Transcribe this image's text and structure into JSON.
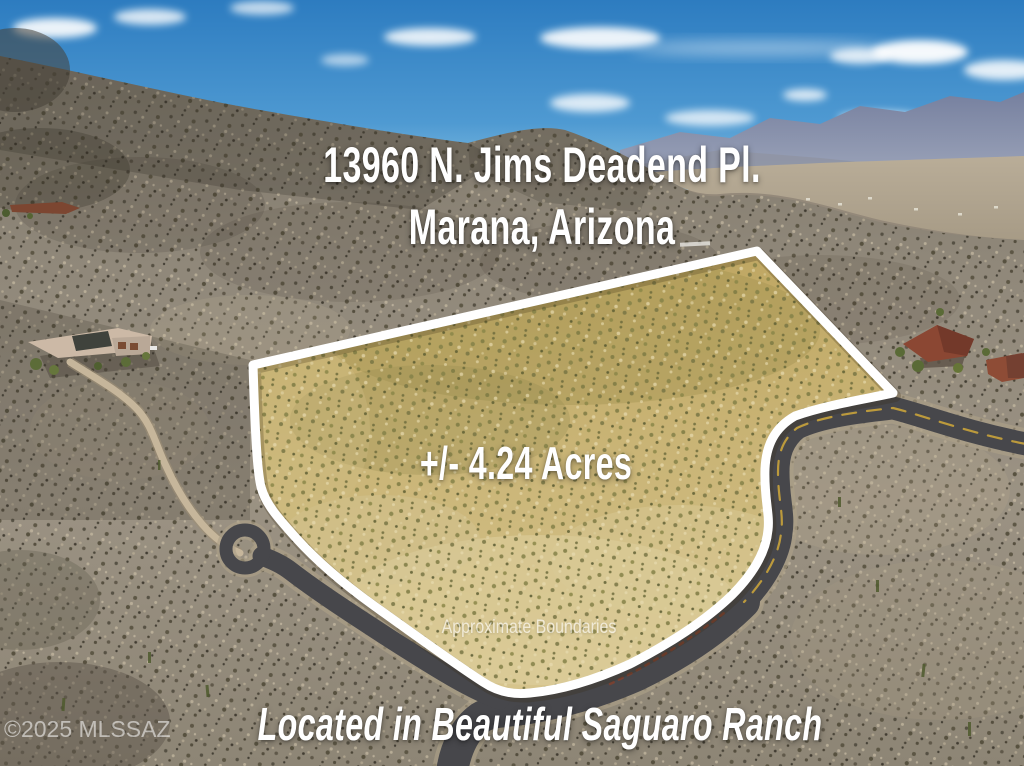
{
  "overlay": {
    "title_line1": "13960 N. Jims Deadend Pl.",
    "title_line2": "Marana, Arizona",
    "acreage": "+/- 4.24 Acres",
    "boundaries_note": "Approximate Boundaries",
    "tagline": "Located in Beautiful Saguaro Ranch",
    "watermark": "©2025 MLSSAZ"
  },
  "scene": {
    "description": "aerial-photo-of-desert-land-parcel",
    "parcel": {
      "label": "+/- 4.24 Acres",
      "boundary_style": "white-outline"
    }
  },
  "colors": {
    "sky_top": "#2d7cc0",
    "sky_mid": "#4f9ad2",
    "sky_horizon": "#8ec6e4",
    "cloud": "#ffffff",
    "mountain_top": "#76809f",
    "mountain_bottom": "#9aa2b8",
    "foothill": "#8f94a3",
    "valley_top": "#b9ad98",
    "valley_bottom": "#a79b86",
    "desert_hill": "#7e776a",
    "desert_mid": "#9b9283",
    "desert_low": "#8d8575",
    "parcel_top": "#bfa763",
    "parcel_bottom": "#d6c48d",
    "boundary_white": "#ffffff",
    "road_asphalt": "#47474b",
    "road_shoulder": "#ac9f87",
    "road_centerline": "#c9a33b",
    "dirt_road": "#c6b69b",
    "guardrail": "#7c4030",
    "roof_red": "#8b4733",
    "roof_red2": "#8e4c36",
    "roof_rust": "#7c4631",
    "roof_tan": "#ccb9a6"
  }
}
